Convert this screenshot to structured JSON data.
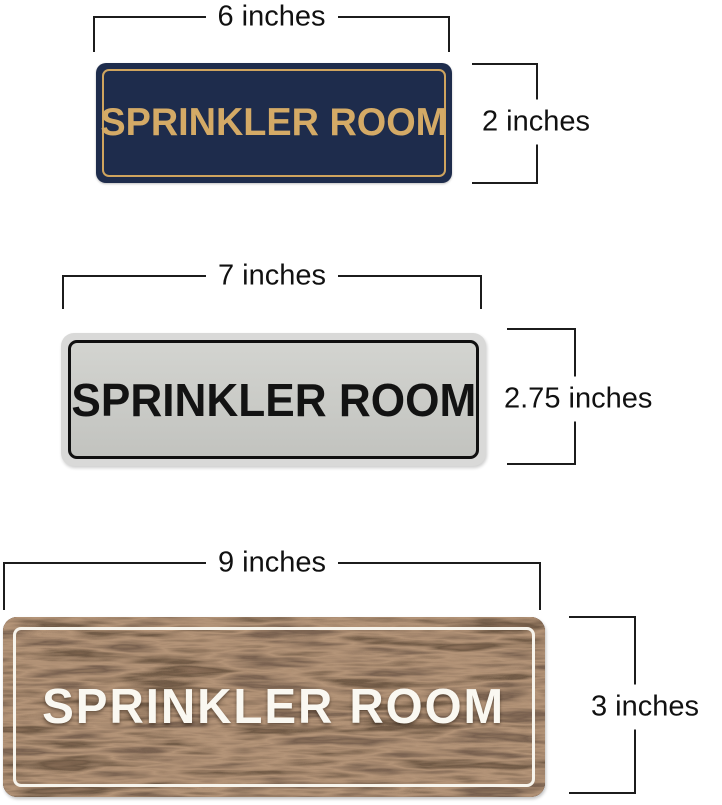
{
  "diagram": {
    "description": "Size comparison diagram of three SPRINKLER ROOM door signs",
    "background_color": "#ffffff",
    "dimension_line_color": "#1c1c1c",
    "dimension_text_color": "#111111"
  },
  "signs": [
    {
      "id": "navy-gold",
      "text": "SPRINKLER ROOM",
      "width_label": "6 inches",
      "height_label": "2 inches",
      "colors": {
        "background": "#1e2c4c",
        "border": "#cfa45e",
        "text": "#d4aa66"
      }
    },
    {
      "id": "silver-black",
      "text": "SPRINKLER ROOM",
      "width_label": "7 inches",
      "height_label": "2.75 inches",
      "colors": {
        "rim": "#d9d9d8",
        "background": "#c9cac6",
        "border": "#101010",
        "text": "#131313"
      }
    },
    {
      "id": "walnut-white",
      "text": "SPRINKLER ROOM",
      "width_label": "9 inches",
      "height_label": "3 inches",
      "colors": {
        "background": "#54392a",
        "border": "#f7f4ec",
        "text": "#faf8f1"
      }
    }
  ]
}
